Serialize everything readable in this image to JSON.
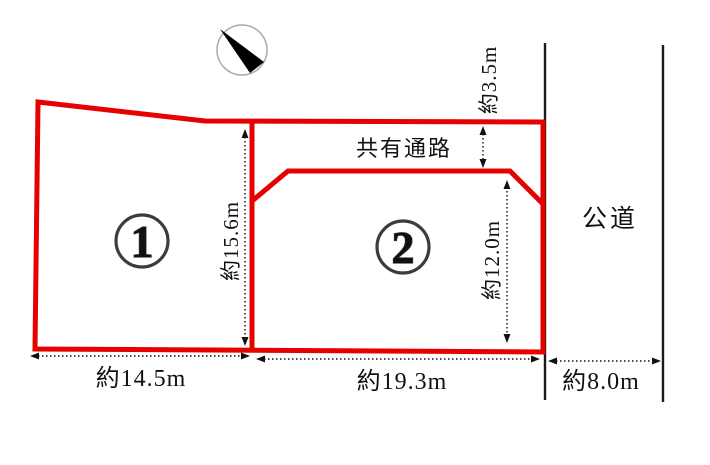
{
  "colors": {
    "boundary": "#e60000",
    "road_line": "#1a1a1a",
    "dimension": "#111111",
    "badge_ring": "#3c3c3c",
    "badge_digit": "#8a8a8a",
    "badge_digit_edge": "#3f3f3f",
    "compass_ring": "#aaaaaa",
    "compass_needle": "#000000",
    "background": "#ffffff"
  },
  "plots": {
    "plot1": {
      "number": "1",
      "frontage": "約14.5m",
      "depth": "約15.6m"
    },
    "plot2": {
      "number": "2",
      "frontage": "約19.3m",
      "depth": "約12.0m"
    }
  },
  "passage": {
    "label": "共有通路",
    "width": "約3.5m"
  },
  "road": {
    "label": "公道",
    "width": "約8.0m"
  }
}
